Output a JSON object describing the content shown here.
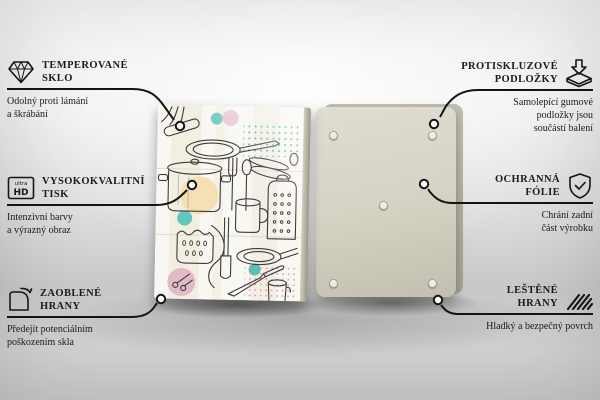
{
  "colors": {
    "line": "#141414",
    "text": "#1b1b1b",
    "back_board": "#d6d3c5",
    "front_board": "#f9f7f1",
    "accent_teal": "#5fc6bb",
    "accent_peach": "#f4deb2",
    "accent_pink": "#e4bac7"
  },
  "icons": {
    "ultra_hd_top": "ultra",
    "ultra_hd_bottom": "HD"
  },
  "product": {
    "front_board": "glass-board-front-kitchen-utensils-print",
    "back_board": "glass-board-back-with-pads"
  },
  "callouts": {
    "left": [
      {
        "icon": "diamond-icon",
        "title_line1": "TEMPEROVANÉ",
        "title_line2": "SKLO",
        "desc_line1": "Odolný proti lámání",
        "desc_line2": "a škrábání"
      },
      {
        "icon": "ultra-hd-icon",
        "title_line1": "VYSOKOKVALITNÍ",
        "title_line2": "TISK",
        "desc_line1": "Intenzivní barvy",
        "desc_line2": "a výrazný obraz"
      },
      {
        "icon": "rounded-corner-icon",
        "title_line1": "ZAOBLENÉ",
        "title_line2": "HRANY",
        "desc_line1": "Předejít potenciálním",
        "desc_line2": "poškozením skla"
      }
    ],
    "right": [
      {
        "icon": "anti-slip-pad-icon",
        "title_line1": "PROTISKLUZOVÉ",
        "title_line2": "PODLOŽKY",
        "desc_line1": "Samolepící gumové",
        "desc_line2": "podložky jsou",
        "desc_line3": "součástí balení"
      },
      {
        "icon": "shield-check-icon",
        "title_line1": "OCHRANNÁ",
        "title_line2": "FÓLIE",
        "desc_line1": "Chrání zadní",
        "desc_line2": "část výrobku"
      },
      {
        "icon": "polished-edge-icon",
        "title_line1": "LEŠTĚNÉ",
        "title_line2": "HRANY",
        "desc_line1": "Hladký a bezpečný povrch"
      }
    ]
  }
}
